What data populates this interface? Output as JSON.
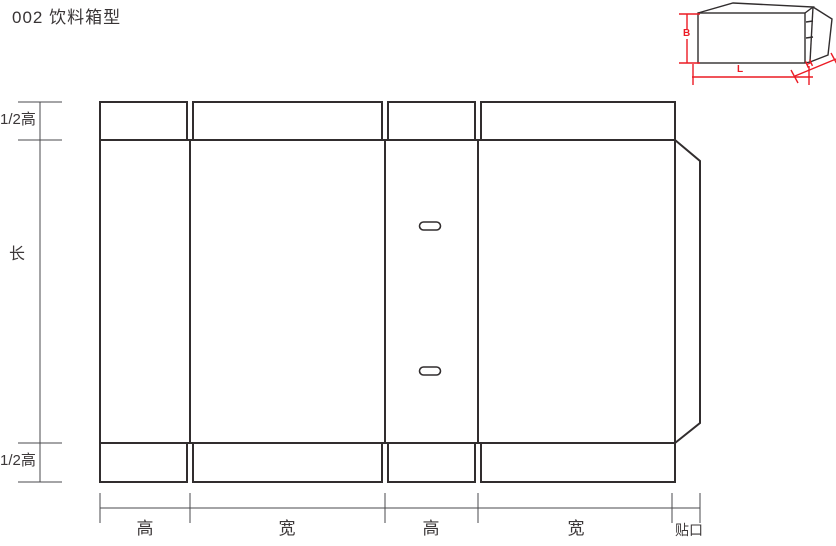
{
  "title": "002 饮料箱型",
  "colors": {
    "line": "#312d2e",
    "dimension": "#4a4a4c",
    "accent_red": "#ec1b24",
    "background": "#ffffff"
  },
  "dieline": {
    "left_dimension_labels": {
      "top_flap": "1/2高",
      "body": "长",
      "bottom_flap": "1/2高"
    },
    "bottom_dimension_labels": {
      "panel_1": "高",
      "panel_2": "宽",
      "panel_3": "高",
      "panel_4": "宽",
      "glue_tab": "贴口"
    }
  },
  "box_preview": {
    "dimension_labels": {
      "height": "B",
      "length": "L",
      "depth": "H"
    }
  }
}
